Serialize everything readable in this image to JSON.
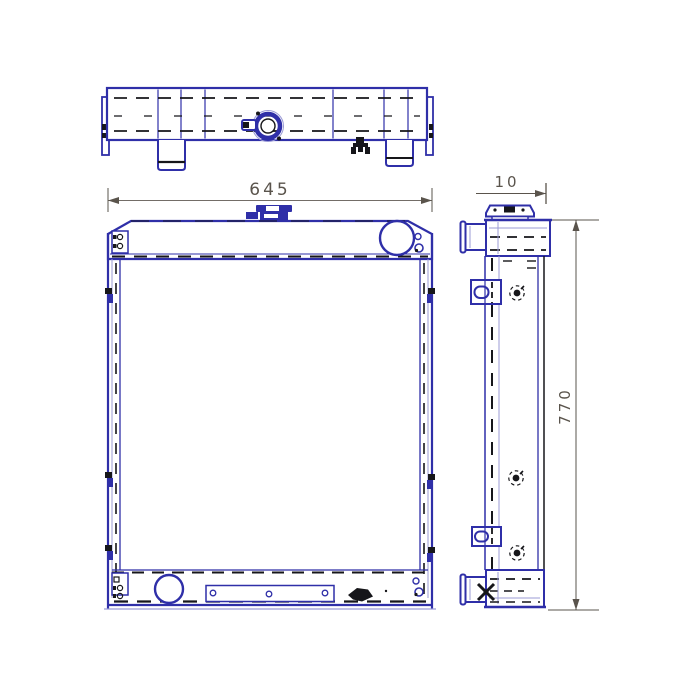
{
  "drawing": {
    "type": "radiator-technical-drawing",
    "dimensions": {
      "width_label": "645",
      "depth_label": "10",
      "height_label": "770"
    },
    "colors": {
      "line_primary": "#2f2fa8",
      "line_secondary": "#9b9bd6",
      "line_dark": "#16161a",
      "dimension": "#5a544c",
      "background": "#ffffff"
    }
  }
}
